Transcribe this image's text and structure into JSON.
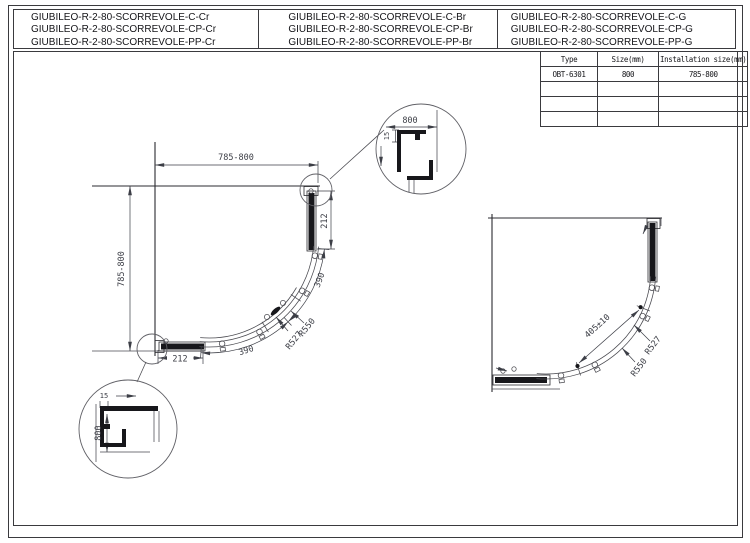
{
  "colors": {
    "line": "#2b2b30",
    "dim_text": "#3c3e46",
    "dark_fill": "#17171b",
    "background": "#ffffff"
  },
  "header": {
    "columns": [
      [
        "GIUBILEO-R-2-80-SCORREVOLE-C-Cr",
        "GIUBILEO-R-2-80-SCORREVOLE-CP-Cr",
        "GIUBILEO-R-2-80-SCORREVOLE-PP-Cr"
      ],
      [
        "GIUBILEO-R-2-80-SCORREVOLE-C-Br",
        "GIUBILEO-R-2-80-SCORREVOLE-CP-Br",
        "GIUBILEO-R-2-80-SCORREVOLE-PP-Br"
      ],
      [
        "GIUBILEO-R-2-80-SCORREVOLE-C-G",
        "GIUBILEO-R-2-80-SCORREVOLE-CP-G",
        "GIUBILEO-R-2-80-SCORREVOLE-PP-G"
      ]
    ]
  },
  "spec_table": {
    "headers": [
      "Type",
      "Size(mm)",
      "Installation size(mm)"
    ],
    "rows": [
      [
        "OBT-6301",
        "800",
        "785-800"
      ],
      [
        "",
        "",
        ""
      ],
      [
        "",
        "",
        ""
      ],
      [
        "",
        "",
        ""
      ]
    ]
  },
  "left_drawing": {
    "dims": {
      "top": "785-800",
      "left": "785-800",
      "right": "212",
      "bottom": "212",
      "arc_upper": "390",
      "arc_lower": "390",
      "radius_outer": "R550",
      "radius_inner": "R527"
    },
    "callout_top": {
      "width": "800",
      "offset": "15"
    },
    "callout_bottom": {
      "height": "800",
      "offset": "15"
    }
  },
  "right_drawing": {
    "dims": {
      "opening": "405±10",
      "radius_inner": "R527",
      "radius_outer": "R550"
    }
  }
}
